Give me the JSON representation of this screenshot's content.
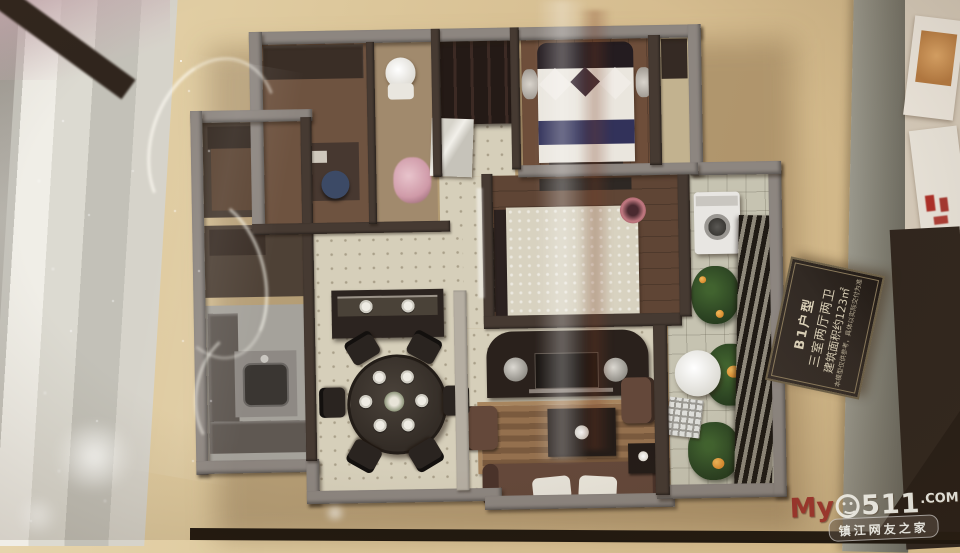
{
  "plaque": {
    "title": "B1户型",
    "layout": "三室两厅两卫",
    "area": "建筑面积约123㎡",
    "note": "本模型仅供参考，具体以实际交付为准"
  },
  "watermark": {
    "prefix": "My",
    "digits": "511",
    "tld": ".COM",
    "tagline": "镇江网友之家"
  },
  "palette": {
    "wall-gray": "#8d8680",
    "wall-dark": "#463a32",
    "tile-cream": "#d6cfba",
    "wood-master": "#6e4e3a",
    "wood-bed2": "#5f4535",
    "kitchen-gray": "#a5a29b",
    "balcony-tile": "#c6c3b1",
    "plant-green": "#2d4523",
    "flower-orange": "#d98a2e",
    "bed-white": "#eae6de",
    "navy-band": "#32325a",
    "sofa-brown": "#64483a",
    "rug-brown": "#8a6748",
    "plaque-bg": "#322a24",
    "plaque-text": "#d9cfb6",
    "watermark-red": "#962e26",
    "watermark-white": "#eeece4"
  }
}
